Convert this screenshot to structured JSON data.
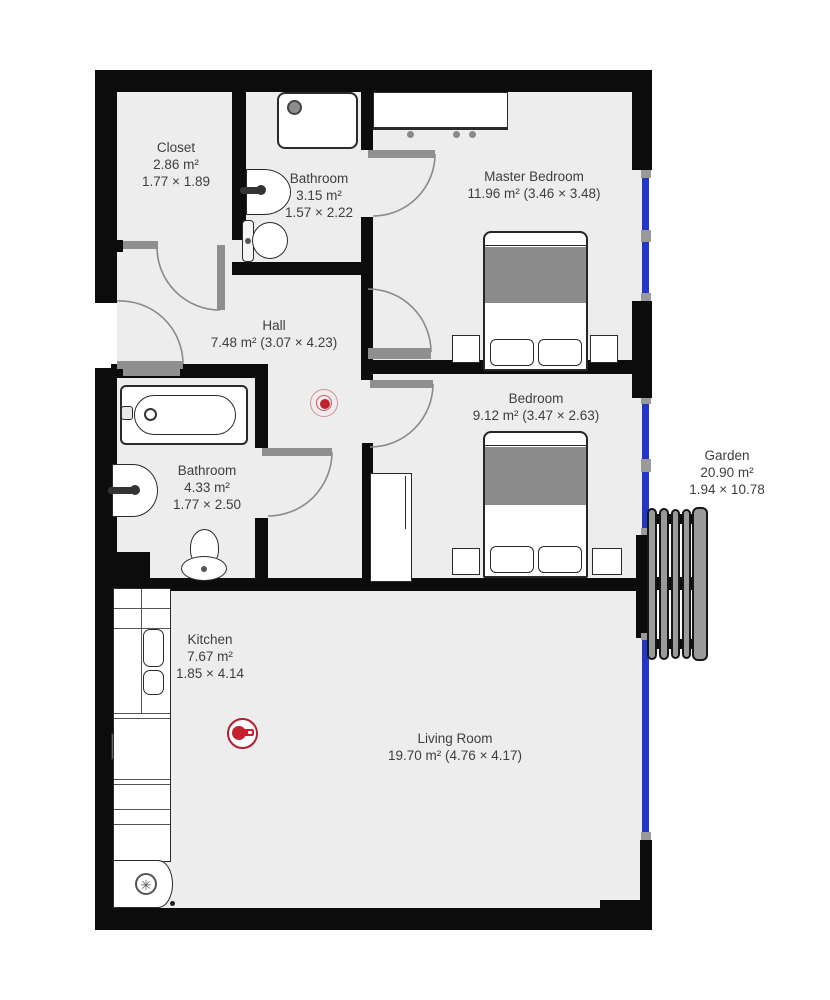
{
  "rooms": {
    "closet": {
      "name": "Closet",
      "area": "2.86 m²",
      "dims": "1.77 × 1.89"
    },
    "bathroom_top": {
      "name": "Bathroom",
      "area": "3.15 m²",
      "dims": "1.57 × 2.22"
    },
    "master_bedroom": {
      "name": "Master Bedroom",
      "area_dims": "11.96 m² (3.46 × 3.48)"
    },
    "hall": {
      "name": "Hall",
      "area_dims": "7.48 m² (3.07 × 4.23)"
    },
    "bedroom": {
      "name": "Bedroom",
      "area_dims": "9.12 m² (3.47 × 2.63)"
    },
    "bathroom_bottom": {
      "name": "Bathroom",
      "area": "4.33 m²",
      "dims": "1.77 × 2.50"
    },
    "garden": {
      "name": "Garden",
      "area": "20.90 m²",
      "dims": "1.94 × 10.78"
    },
    "kitchen": {
      "name": "Kitchen",
      "area": "7.67 m²",
      "dims": "1.85 × 4.14"
    },
    "living_room": {
      "name": "Living Room",
      "area_dims": "19.70 m² (4.76 × 4.17)"
    }
  },
  "icons": {
    "thermostat": "thermostat-radiator-dial",
    "cooktop": "cooking-pan",
    "fridge": "snowflake"
  },
  "colors": {
    "wall": "#0c0c0c",
    "floor": "#ededee",
    "window": "#2337c6",
    "leaf": "#8f8f8f",
    "blanket": "#8c8c8c",
    "accent_red": "#c5202d",
    "ring_red": "#d98f94",
    "pan_red": "#b01e30",
    "fence": "#9a9a9a",
    "text": "#3e3e3e"
  },
  "fridge_icon_glyph": "✳"
}
